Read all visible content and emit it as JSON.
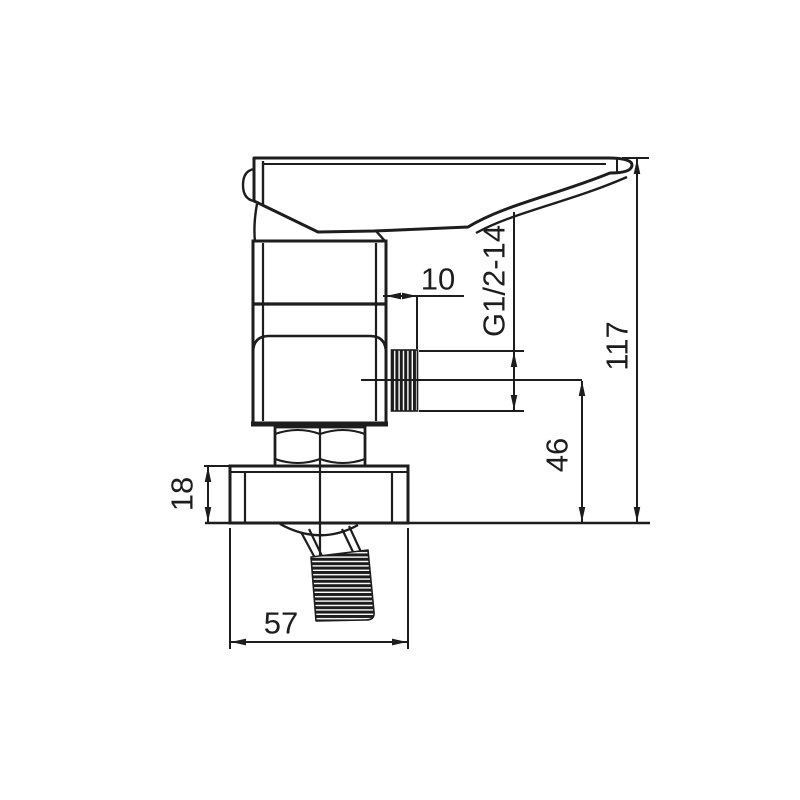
{
  "page": {
    "background": "#ffffff",
    "ink": "#1d1d1d"
  },
  "drawing": {
    "description": "Technical line drawing, side elevation of a single-lever wall-mounted mixer valve with threaded outlets",
    "dimension_labels": {
      "outlet_protrusion": "10",
      "outlet_thread": "G1/2-14",
      "overall_height": "117",
      "outlet_center_to_wall": "46",
      "wall_plate_depth": "18",
      "wall_plate_width": "57"
    }
  }
}
